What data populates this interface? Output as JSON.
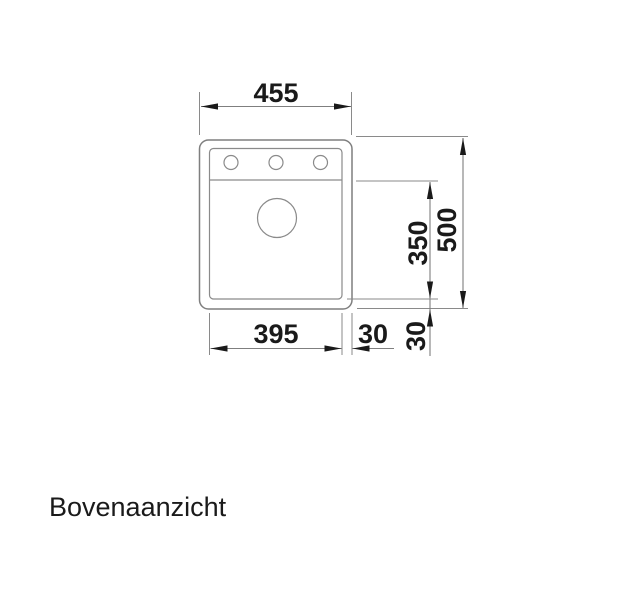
{
  "view": {
    "label": "Bovenaanzicht"
  },
  "colors": {
    "background": "#ffffff",
    "drawing_line": "#7f7f7f",
    "ink": "#1a1a1a"
  },
  "drawing": {
    "subject": "sink-top-view",
    "dims": {
      "overall_width": "455",
      "overall_depth": "500",
      "bowl_depth": "350",
      "bowl_width": "395",
      "rim_right": "30",
      "rim_bottom": "30"
    }
  }
}
